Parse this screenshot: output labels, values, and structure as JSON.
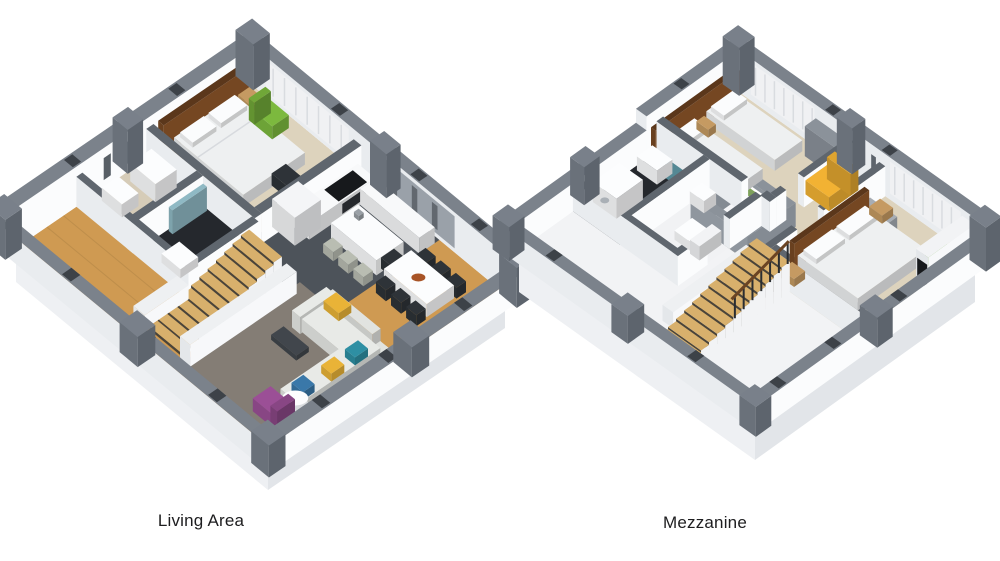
{
  "page": {
    "background": "#ffffff",
    "type": "3d-floor-plan-render"
  },
  "floor_plans": [
    {
      "id": "living-area",
      "label": "Living Area",
      "rooms": [
        "bedroom",
        "bathroom",
        "hallway",
        "kitchen",
        "dining area",
        "living room",
        "staircase"
      ],
      "furniture": [
        "double bed",
        "nightstands",
        "green armchair",
        "desk",
        "desk chair",
        "wardrobe",
        "kitchen counter",
        "cooktop",
        "refrigerator",
        "kitchen island",
        "bar stools",
        "dining table",
        "dining chairs",
        "fruit bowl",
        "sectional sofa",
        "throw pillows",
        "coffee tables",
        "purple armchair",
        "area rug",
        "tv console",
        "washing machine",
        "shower",
        "toilet",
        "staircase"
      ]
    },
    {
      "id": "mezzanine",
      "label": "Mezzanine",
      "rooms": [
        "twin bedroom",
        "double bedroom",
        "bathroom",
        "wc",
        "landing",
        "stair void",
        "open room"
      ],
      "furniture": [
        "single beds",
        "double bed",
        "nightstands",
        "wardrobe",
        "yellow armchair",
        "desk",
        "desk chair",
        "washing machine",
        "toilet",
        "sink",
        "green beanbag",
        "wall art",
        "tv wall",
        "staircase",
        "stair railing"
      ]
    }
  ],
  "colors": {
    "background": "#ffffff",
    "label": "#1d1d1f",
    "baseFloor": "#f2f3f5",
    "slabLight": "#eef0f3",
    "slabShade": "#e2e5e9",
    "wallTop": "#7b828b",
    "wallFaceLight": "#fbfcfd",
    "wallFaceShade": "#e9ecef",
    "interiorWallTop": "#5f666e",
    "post": "#6d747c",
    "wood": "#cf9a52",
    "carpet": "#ddd3bd",
    "hall": "#d6ccb8",
    "kitchenFloor": "#4d535a",
    "tileDark": "#25282d",
    "rug": "#847d75",
    "sofa": "#e8eae7",
    "bedWhite": "#eef0f1",
    "pillowWhite": "#fbfcfd",
    "headboard": "#754722",
    "woodFurn": "#c59a62",
    "chairGreen": "#7cb93e",
    "chairYellow": "#f2b233",
    "chairPurple": "#9b4f96",
    "beanbag": "#6fae3f",
    "pillowYellow": "#e9b337",
    "pillowTeal": "#2e8fa3",
    "pillowBlue": "#3a78a9",
    "darkChair": "#2e3338",
    "stairWood": "#d8b06c",
    "stairRiser": "#4a443a",
    "applianceWhite": "#fcfdfe",
    "tableWhite": "#fcfdfe",
    "bowl": "#a85427",
    "glassTeal": "#8fb9c4",
    "parapet": "#8b929a",
    "artGreen": "#7da05a",
    "black": "#17191c",
    "railDark": "#2a2d31",
    "handrail": "#6b4423",
    "deskGray": "#a7adb4",
    "stoolGray": "#b9bdb2"
  }
}
